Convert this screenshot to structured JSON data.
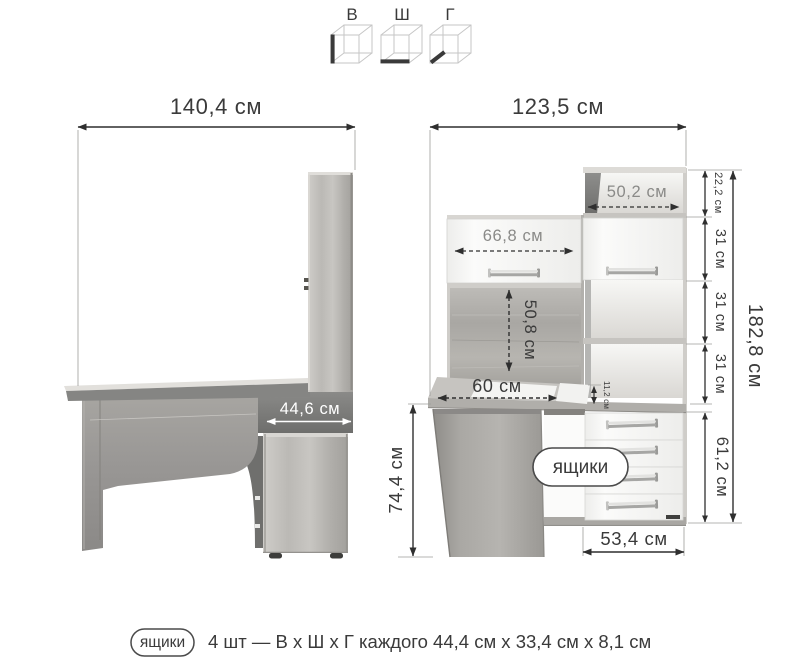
{
  "legend": {
    "items": [
      {
        "label": "В",
        "highlight": "height-edge"
      },
      {
        "label": "Ш",
        "highlight": "width-edge"
      },
      {
        "label": "Г",
        "highlight": "depth-edge"
      }
    ]
  },
  "side_view": {
    "overall_width": "140,4 см",
    "pedestal_depth": "44,6 см"
  },
  "front_view": {
    "overall_width": "123,5 см",
    "overall_height": "182,8 см",
    "niche_width": "50,2 см",
    "door_width": "66,8 см",
    "sections": [
      "22,2 см",
      "31 см",
      "31 см",
      "31 см"
    ],
    "back_panel_height": "50,8 см",
    "desktop_depth": "60 см",
    "ledge_height": "11,2 см",
    "desk_height": "74,4 см",
    "drawer_unit_height": "61,2 см",
    "drawer_unit_width": "53,4 см",
    "drawers_callout": "ящики"
  },
  "footer": {
    "badge": "ящики",
    "text": "4 шт — В х Ш х Г каждого 44,4 см х 33,4 см х 8,1 см"
  },
  "colors": {
    "ink": "#3a3a3a",
    "wood_light": "#c9c7c2",
    "wood_dark": "#8f8d89",
    "white_front": "#f9f9f8"
  }
}
